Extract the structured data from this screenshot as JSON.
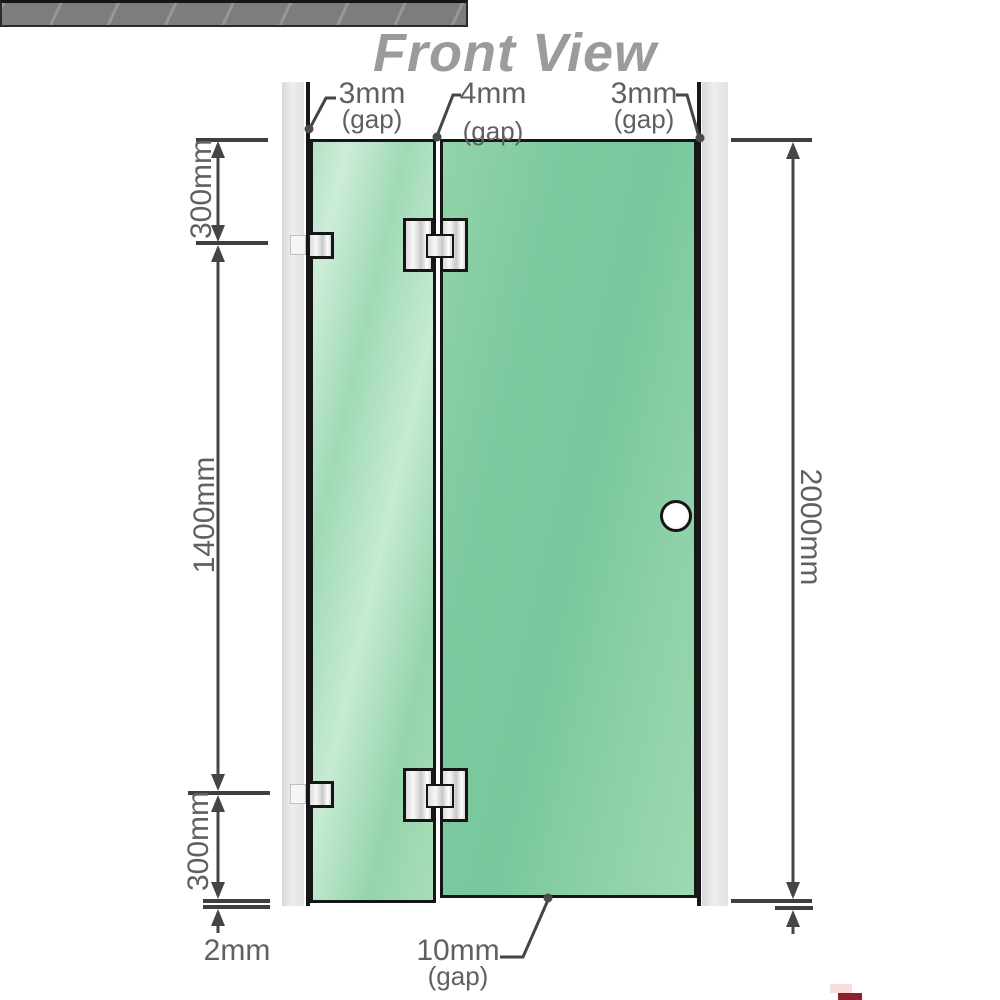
{
  "title": "Front View",
  "diagram": {
    "type": "shower-screen-front-view",
    "top_gap_labels": {
      "left": {
        "value": "3mm",
        "qualifier": "(gap)"
      },
      "middle": {
        "value": "4mm",
        "qualifier": "(gap)"
      },
      "right": {
        "value": "3mm",
        "qualifier": "(gap)"
      }
    },
    "left_dimensions": {
      "top_segment": "300mm",
      "middle_segment": "1400mm",
      "bottom_segment": "300mm",
      "floor_gap": "2mm"
    },
    "right_dimension": {
      "total_height": "2000mm"
    },
    "bottom_gap_label": {
      "value": "10mm",
      "qualifier": "(gap)"
    }
  },
  "colors": {
    "glass_green": "#84cda2",
    "glass_highlight": "#c6ead2",
    "wall_channel_gray": "#e4e4e4",
    "floor_gray": "#7d7d7d",
    "outline_black": "#161616",
    "dimension_line_gray": "#454545",
    "label_text_gray": "#606060",
    "title_gray": "#9b9b9b",
    "corner_mark_red": "#8e1f2c"
  }
}
